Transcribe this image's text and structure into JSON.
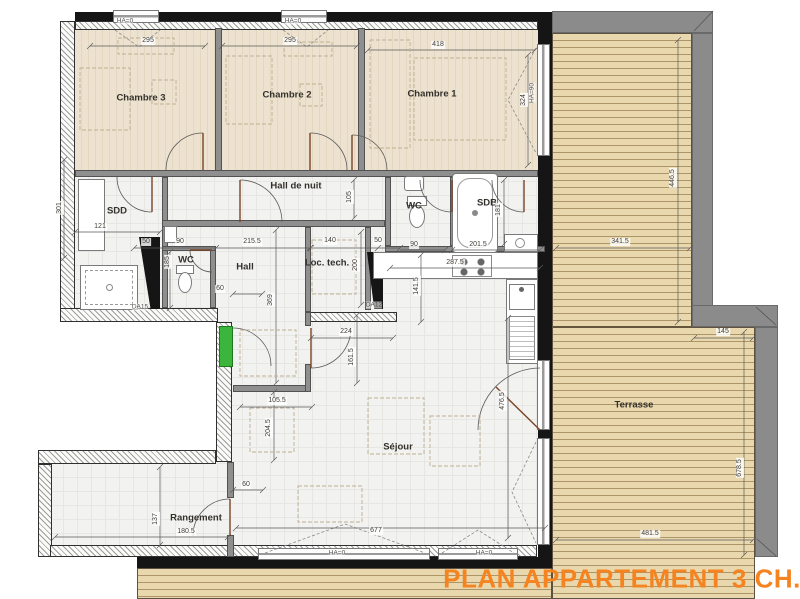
{
  "title": "PLAN APPARTEMENT 3 CH.",
  "colors": {
    "accent_orange": "#f5831f",
    "entry_door_green": "#3bb53b",
    "terrace_plank": "#e9d8ad",
    "parapet_gray": "#8b8b8b",
    "room_floor_beige": "#ece2cf",
    "wall_black": "#151515"
  },
  "rooms": [
    {
      "label": "Chambre 3"
    },
    {
      "label": "Chambre 2"
    },
    {
      "label": "Chambre 1"
    },
    {
      "label": "Hall de nuit"
    },
    {
      "label": "SDD"
    },
    {
      "label": "WC"
    },
    {
      "label": "Hall"
    },
    {
      "label": "Loc. tech."
    },
    {
      "label": "WC"
    },
    {
      "label": "SDB"
    },
    {
      "label": "Séjour"
    },
    {
      "label": "Rangement"
    },
    {
      "label": "Terrasse"
    }
  ],
  "dims": [
    {
      "label": "295"
    },
    {
      "label": "295"
    },
    {
      "label": "418"
    },
    {
      "label": "324"
    },
    {
      "label": "446.5"
    },
    {
      "label": "341.5"
    },
    {
      "label": "145"
    },
    {
      "label": "678.5"
    },
    {
      "label": "481.5"
    },
    {
      "label": "105"
    },
    {
      "label": "121"
    },
    {
      "label": "301"
    },
    {
      "label": "50"
    },
    {
      "label": "90"
    },
    {
      "label": "215.5"
    },
    {
      "label": "185"
    },
    {
      "label": "140"
    },
    {
      "label": "50"
    },
    {
      "label": "90"
    },
    {
      "label": "201.5"
    },
    {
      "label": "200"
    },
    {
      "label": "181"
    },
    {
      "label": "287.5"
    },
    {
      "label": "141.5"
    },
    {
      "label": "369"
    },
    {
      "label": "224"
    },
    {
      "label": "161.5"
    },
    {
      "label": "105.5"
    },
    {
      "label": "204.5"
    },
    {
      "label": "60"
    },
    {
      "label": "60"
    },
    {
      "label": "137"
    },
    {
      "label": "180.5"
    },
    {
      "label": "677"
    },
    {
      "label": "476.5"
    }
  ],
  "annotations": [
    {
      "label": "HA=0"
    },
    {
      "label": "HA=0"
    },
    {
      "label": "HA=0"
    },
    {
      "label": "HA=0"
    },
    {
      "label": "HA=90"
    },
    {
      "label": "DA15"
    },
    {
      "label": "DA12"
    }
  ]
}
